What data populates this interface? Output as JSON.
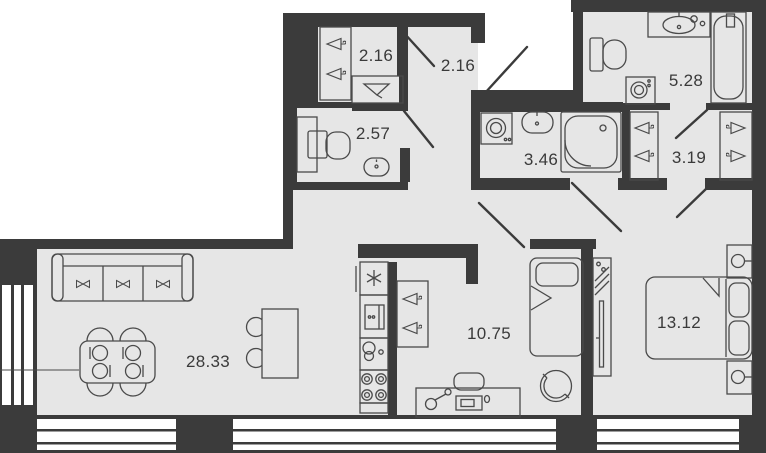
{
  "floorplan": {
    "title": "apartment-floor-plan",
    "colors": {
      "wall": "#3b3b3b",
      "floor": "#e6e6e6",
      "line": "#4a4a4a",
      "background": "#ffffff"
    },
    "rooms": [
      {
        "id": "closet-top",
        "label": "2.16"
      },
      {
        "id": "hall-entry",
        "label": "2.16"
      },
      {
        "id": "wc",
        "label": "2.57"
      },
      {
        "id": "shower-room",
        "label": "3.46"
      },
      {
        "id": "bathroom",
        "label": "5.28"
      },
      {
        "id": "walkin-wardrobe",
        "label": "3.19"
      },
      {
        "id": "living-kitchen",
        "label": "28.33"
      },
      {
        "id": "bedroom-second",
        "label": "10.75"
      },
      {
        "id": "bedroom-master",
        "label": "13.12"
      }
    ]
  }
}
